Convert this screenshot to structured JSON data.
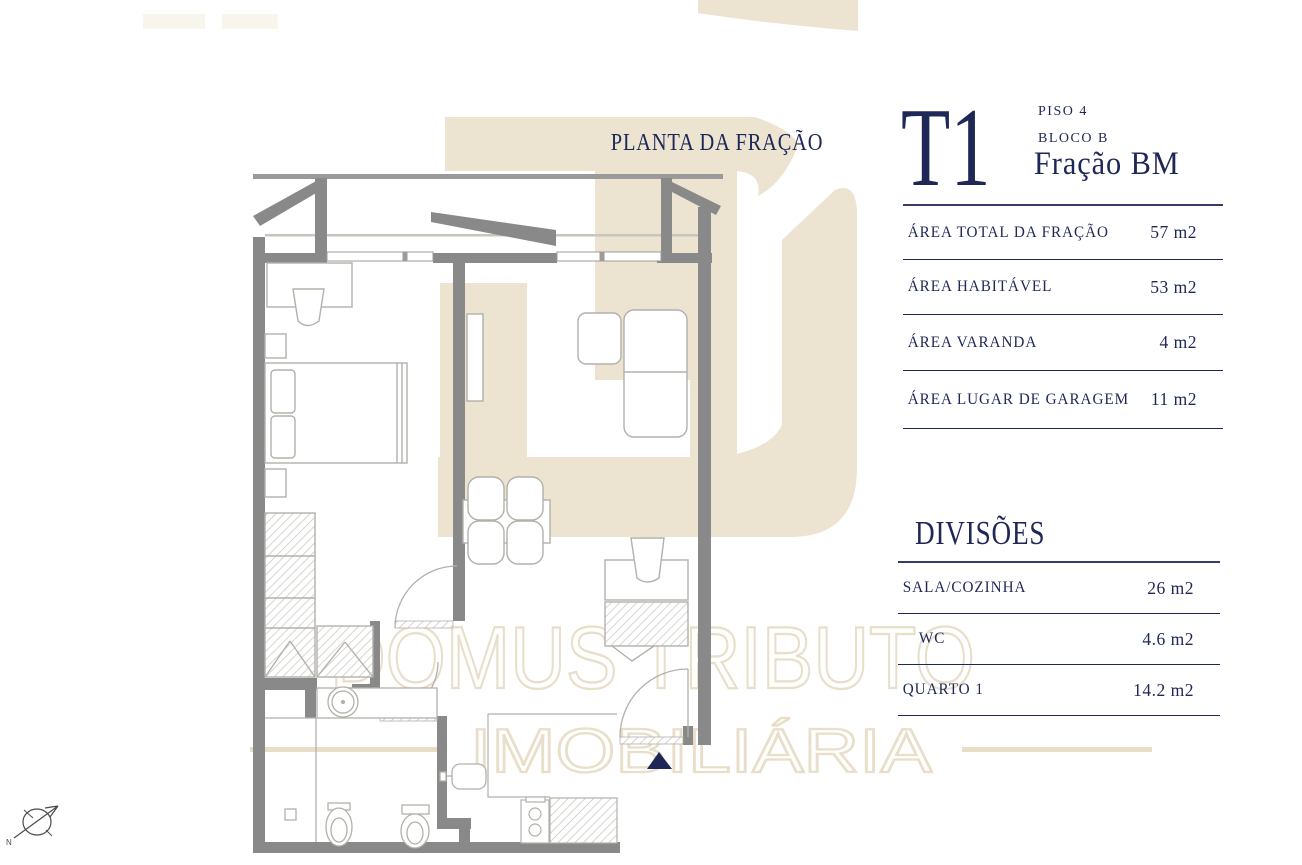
{
  "plan": {
    "title": "PLANTA DA FRAÇÃO",
    "watermark": {
      "line1": "DOMUS TRIBUTO",
      "line2": "IMOBILIÁRIA"
    },
    "compass_label": "N"
  },
  "panel": {
    "typology": "T1",
    "floor": "PISO 4",
    "block": "BLOCO B",
    "fraction": "Fração  BM",
    "areas": {
      "rows": [
        {
          "label": "ÁREA TOTAL DA FRAÇÃO",
          "value": "57 m2"
        },
        {
          "label": "ÁREA HABITÁVEL",
          "value": "53 m2"
        },
        {
          "label": "ÁREA VARANDA",
          "value": "4  m2"
        },
        {
          "label": "ÁREA LUGAR DE GARAGEM",
          "value": "11  m2"
        }
      ]
    },
    "divisions": {
      "title": "DIVISÕES",
      "rows": [
        {
          "label": "SALA/COZINHA",
          "value": "26 m2"
        },
        {
          "label": "WC",
          "value": "4.6 m2"
        },
        {
          "label": "QUARTO 1",
          "value": "14.2 m2"
        }
      ]
    }
  },
  "colors": {
    "navy": "#1e2756",
    "logo_beige": "#ece3d1",
    "watermark_beige": "#e8ddc7",
    "wall_gray": "#898989"
  }
}
